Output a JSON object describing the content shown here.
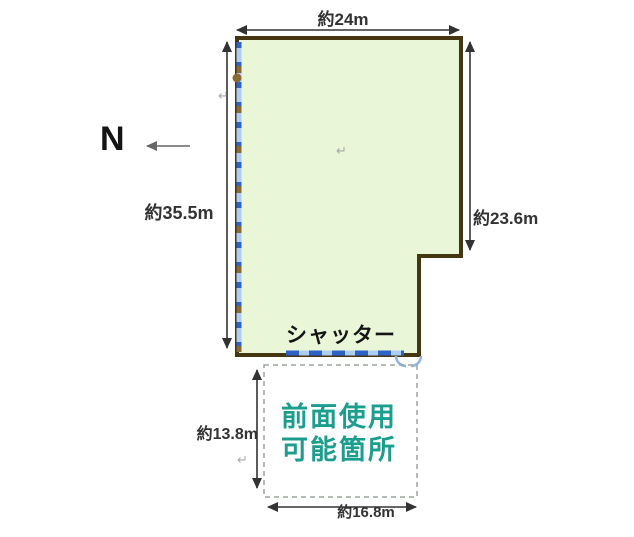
{
  "dimensions": {
    "top_width": "約24m",
    "left_height": "約35.5m",
    "right_height": "約23.6m",
    "front_height": "約13.8m",
    "front_width": "約16.8m"
  },
  "labels": {
    "north": "N",
    "shutter": "シャッター",
    "front_area_line1": "前面使用",
    "front_area_line2": "可能箇所"
  },
  "marks": {
    "return_mark": "↵"
  },
  "colors": {
    "parcel_fill": "#e9f6d8",
    "parcel_border": "#453612",
    "shutter_base": "#aecdf4",
    "shutter_dash": "#2d63c8",
    "shutter_dash_brown": "#8a6a34",
    "front_text": "#1b9e8e",
    "front_border": "#9aa79a",
    "dim_color": "#333333",
    "north_color": "#141414",
    "artifact": "#9b9b9b",
    "door": "#8fb4e8"
  }
}
